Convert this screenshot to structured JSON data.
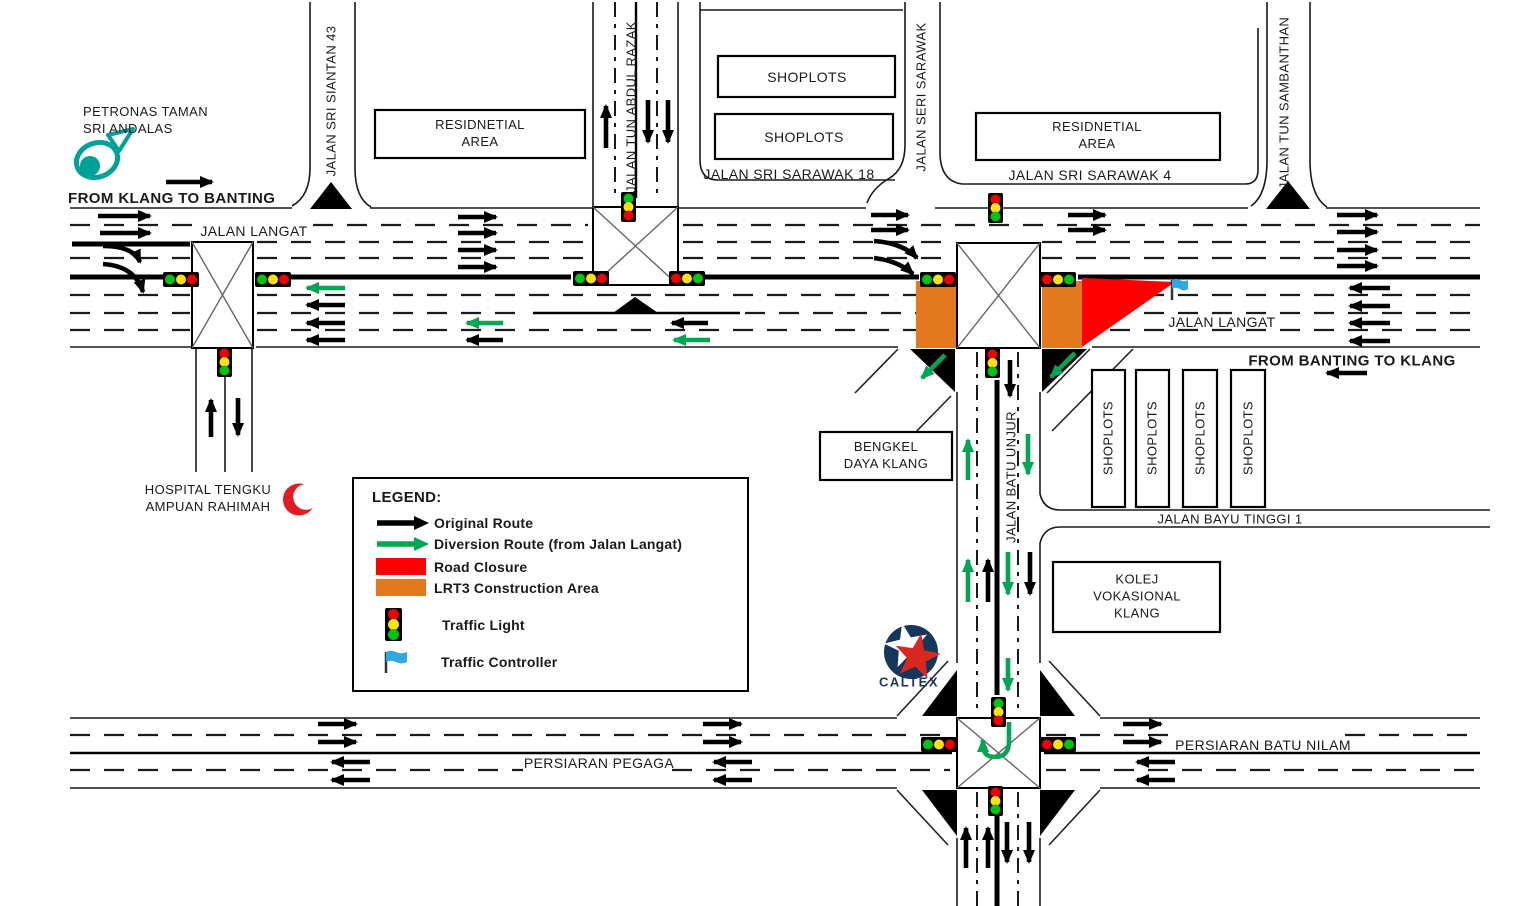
{
  "labels": {
    "petronas_line1": "PETRONAS TAMAN",
    "petronas_line2": "SRI ANDALAS",
    "from_klang_to_banting": "FROM KLANG TO BANTING",
    "jalan_langat": "JALAN LANGAT",
    "jalan_sri_siantan_43": "JALAN SRI SIANTAN 43",
    "jalan_tun_abdul_razak": "JALAN TUN ABDUL RAZAK",
    "residential_line1": "RESIDNETIAL",
    "residential_line2": "AREA",
    "shoplots": "SHOPLOTS",
    "jalan_sri_sarawak_18": "JALAN SRI SARAWAK 18",
    "jalan_seri_sarawak": "JALAN SERI SARAWAK",
    "jalan_sri_sarawak_4": "JALAN SRI SARAWAK 4",
    "jalan_tun_sambanthan": "JALAN TUN SAMBANTHAN",
    "from_banting_to_klang": "FROM BANTING TO KLANG",
    "hospital_line1": "HOSPITAL TENGKU",
    "hospital_line2": "AMPUAN RAHIMAH",
    "bengkel_line1": "BENGKEL",
    "bengkel_line2": "DAYA KLANG",
    "jalan_batu_unjur": "JALAN BATU UNJUR",
    "jalan_bayu_tinggi_1": "JALAN BAYU TINGGI 1",
    "kolej_line1": "KOLEJ",
    "kolej_line2": "VOKASIONAL",
    "kolej_line3": "KLANG",
    "caltex": "CALTEX",
    "persiaran_pegaga": "PERSIARAN PEGAGA",
    "persiaran_batu_nilam": "PERSIARAN BATU NILAM"
  },
  "legend": {
    "title": "LEGEND:",
    "items": [
      {
        "swatch": "black-arrow",
        "label": "Original Route"
      },
      {
        "swatch": "green-arrow",
        "label": "Diversion Route (from Jalan Langat)"
      },
      {
        "swatch": "red-rect",
        "label": "Road Closure"
      },
      {
        "swatch": "orange-rect",
        "label": "LRT3 Construction Area"
      },
      {
        "swatch": "traffic-light",
        "label": "Traffic Light"
      },
      {
        "swatch": "blue-flag",
        "label": "Traffic Controller"
      }
    ]
  },
  "colors": {
    "original_route": "#000000",
    "diversion_route": "#00A651",
    "road_closure": "#FF0000",
    "lrt3_construction": "#E2791F",
    "traffic_controller_flag": "#2FA8E0",
    "traffic_light_red": "#F00000",
    "traffic_light_yellow": "#FFE20A",
    "traffic_light_green": "#00C414",
    "petronas_teal": "#00A19B",
    "caltex_navy": "#17365C",
    "caltex_red": "#DA291C",
    "red_crescent": "#E31B23"
  }
}
